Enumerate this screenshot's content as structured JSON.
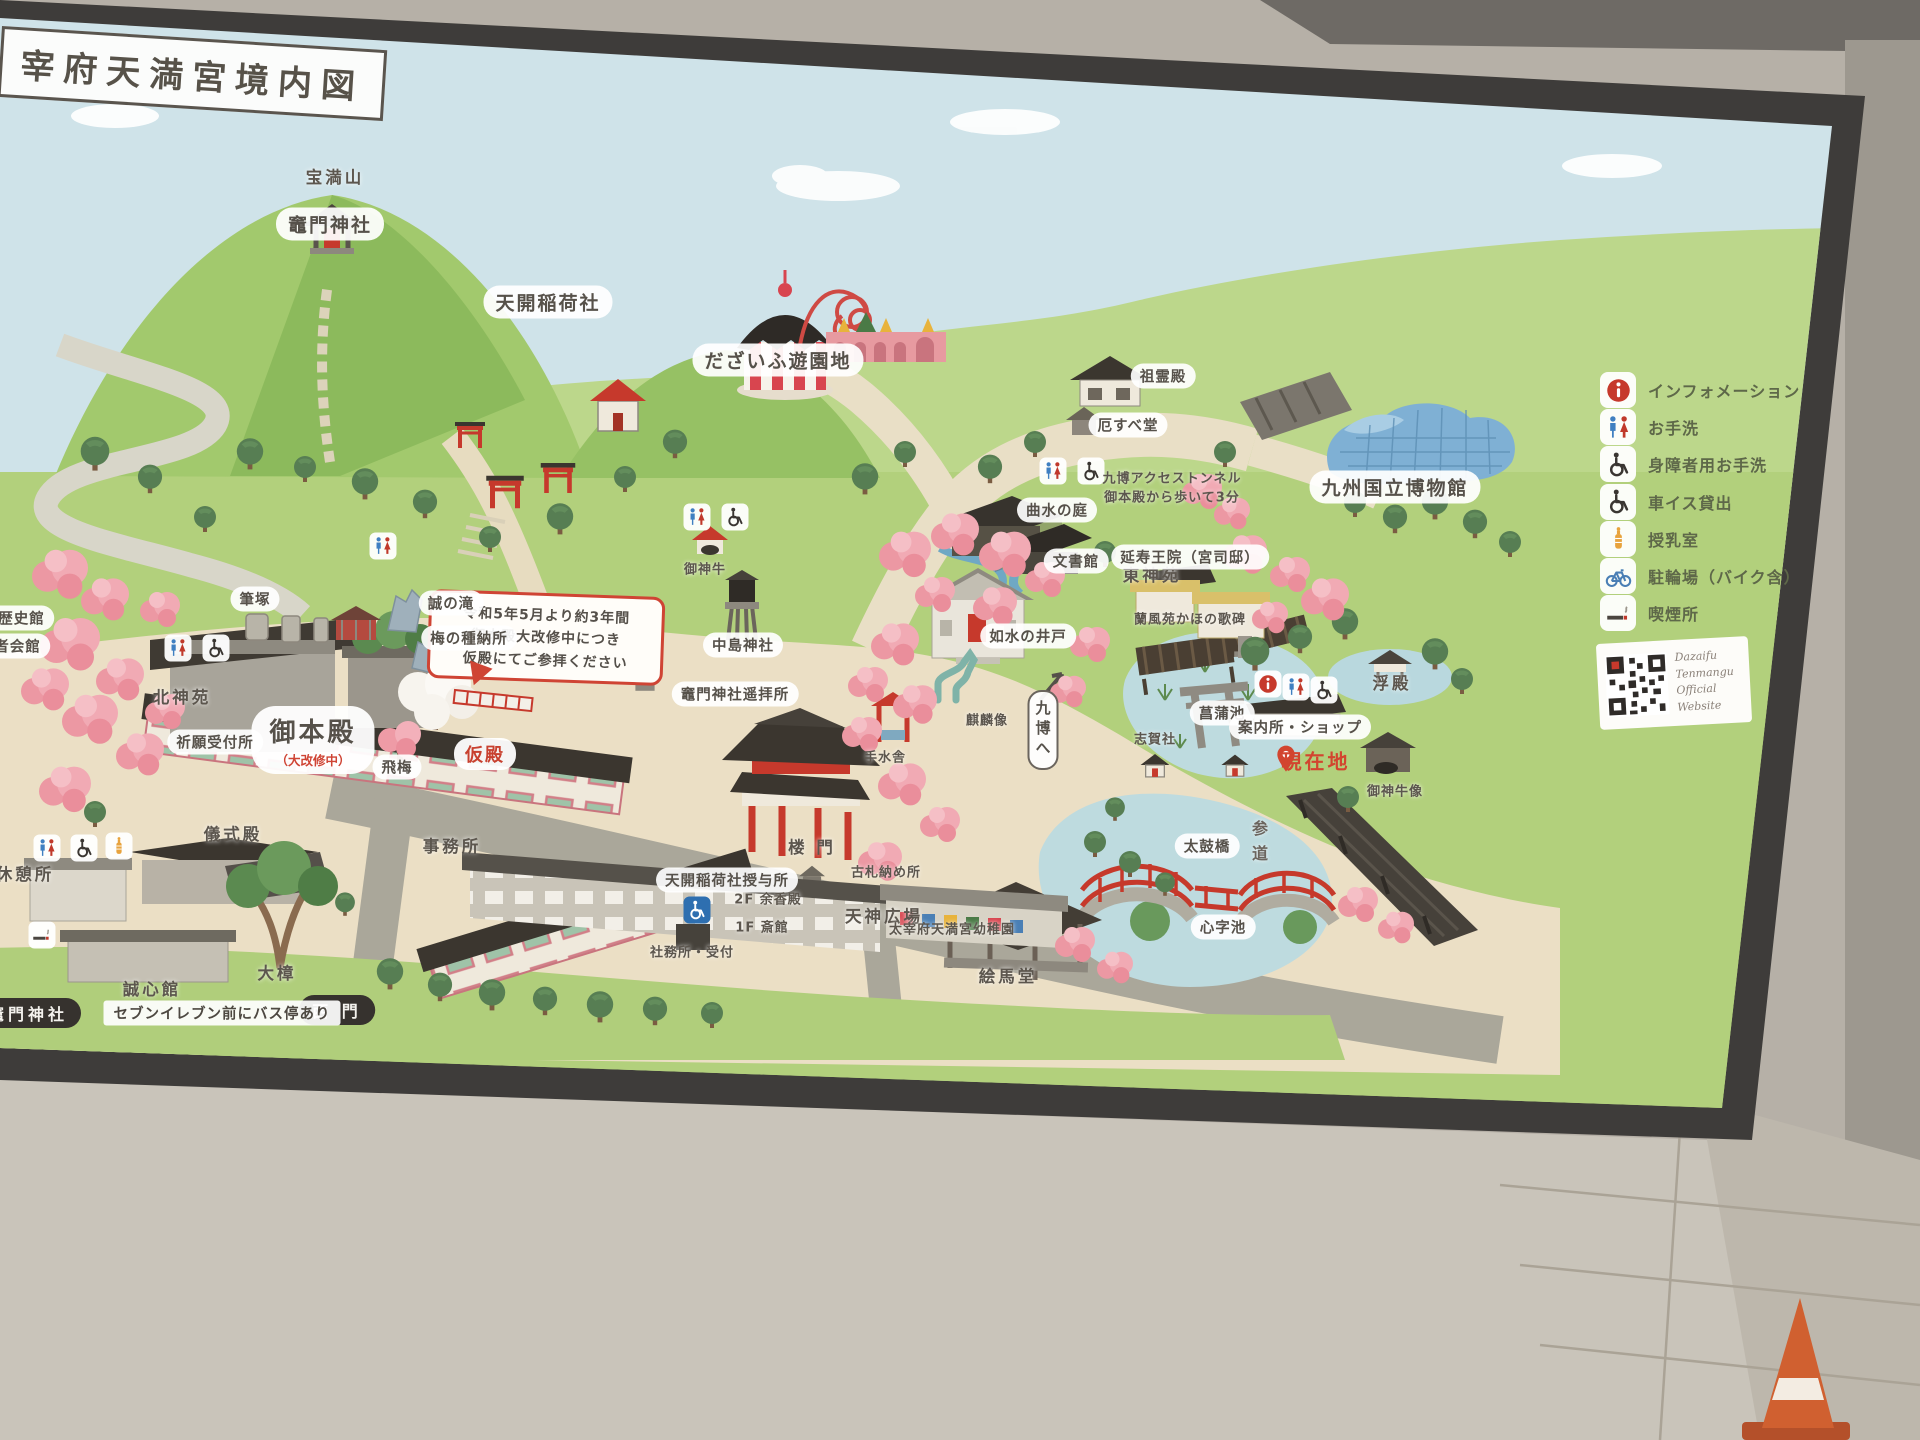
{
  "board": {
    "title": "宰府天満宮境内図",
    "notice_bubble": {
      "lines": [
        "令和5年5月より約3年間",
        "御本殿大改修中につき",
        "仮殿にてご参拝ください"
      ]
    },
    "legend": {
      "items": [
        {
          "icon": "info-icon",
          "label": "インフォメーション"
        },
        {
          "icon": "toilet-icon",
          "label": "お手洗"
        },
        {
          "icon": "wheelchair-icon",
          "label": "身障者用お手洗"
        },
        {
          "icon": "wheelchair-icon",
          "label": "車イス貸出"
        },
        {
          "icon": "nursing-icon",
          "label": "授乳室"
        },
        {
          "icon": "bicycle-icon",
          "label": "駐輪場（バイク含）"
        },
        {
          "icon": "smoking-icon",
          "label": "喫煙所"
        }
      ],
      "qr_caption_line1": "Dazaifu Tenmangu",
      "qr_caption_line2": "Official Website"
    },
    "labels": [
      {
        "n": "homanzan",
        "t": "宝満山",
        "x": 335,
        "y": 176,
        "s": "plain"
      },
      {
        "n": "kamado-jinja",
        "t": "竈門神社",
        "x": 330,
        "y": 224,
        "s": "pill"
      },
      {
        "n": "tenkai-inari-sha",
        "t": "天開稲荷社",
        "x": 548,
        "y": 302,
        "s": "pill"
      },
      {
        "n": "dazaifu-yuenchi",
        "t": "だざいふ遊園地",
        "x": 778,
        "y": 360,
        "s": "pill"
      },
      {
        "n": "soreiden",
        "t": "祖霊殿",
        "x": 1163,
        "y": 376,
        "s": "pill-sm"
      },
      {
        "n": "yakusube-do",
        "t": "厄すべ堂",
        "x": 1128,
        "y": 425,
        "s": "pill-sm"
      },
      {
        "n": "kyuhaku-access-tunnel",
        "t": "九博アクセストンネル",
        "x": 1172,
        "y": 477,
        "s": "plain-sm"
      },
      {
        "n": "tunnel-note",
        "t": "御本殿から歩いて3分",
        "x": 1172,
        "y": 496,
        "s": "plain-sm"
      },
      {
        "n": "kyushu-national-museum",
        "t": "九州国立博物館",
        "x": 1395,
        "y": 487,
        "s": "pill"
      },
      {
        "n": "kyokusui-no-niwa",
        "t": "曲水の庭",
        "x": 1057,
        "y": 510,
        "s": "pill-sm"
      },
      {
        "n": "bunshokan",
        "t": "文書館",
        "x": 1076,
        "y": 561,
        "s": "pill-sm"
      },
      {
        "n": "higashi-shin-en",
        "t": "東神苑",
        "x": 1152,
        "y": 574,
        "s": "plain"
      },
      {
        "n": "josui-no-ido",
        "t": "如水の井戸",
        "x": 1028,
        "y": 636,
        "s": "pill-sm"
      },
      {
        "n": "kirin-zo",
        "t": "麒麟像",
        "x": 987,
        "y": 719,
        "s": "plain-sm"
      },
      {
        "n": "kyuhaku-e",
        "t": "九博へ",
        "x": 1043,
        "y": 730,
        "s": "vpill"
      },
      {
        "n": "shobu-ike",
        "t": "菖蒲池",
        "x": 1222,
        "y": 713,
        "s": "pill-sm"
      },
      {
        "n": "shiga-sha",
        "t": "志賀社",
        "x": 1155,
        "y": 738,
        "s": "plain-sm"
      },
      {
        "n": "taiko-bashi",
        "t": "太鼓橋",
        "x": 1207,
        "y": 846,
        "s": "pill-sm"
      },
      {
        "n": "shinji-ike",
        "t": "心字池",
        "x": 1223,
        "y": 927,
        "s": "pill-sm"
      },
      {
        "n": "emado",
        "t": "絵馬堂",
        "x": 1008,
        "y": 975,
        "s": "plain"
      },
      {
        "n": "fudezuka",
        "t": "筆塚",
        "x": 255,
        "y": 599,
        "s": "pill-sm"
      },
      {
        "n": "makoto-no-taki",
        "t": "誠の滝",
        "x": 451,
        "y": 603,
        "s": "pill-sm"
      },
      {
        "n": "ume-no-tane-osamedokoro",
        "t": "梅の種納所",
        "x": 469,
        "y": 638,
        "s": "pill-sm"
      },
      {
        "n": "kita-shin-en",
        "t": "北神苑",
        "x": 182,
        "y": 696,
        "s": "plain"
      },
      {
        "n": "gohonden",
        "t": "御本殿",
        "x": 313,
        "y": 740,
        "s": "pill-lg",
        "sub": "（大改修中）"
      },
      {
        "n": "tobiume",
        "t": "飛梅",
        "x": 397,
        "y": 767,
        "s": "pill-sm"
      },
      {
        "n": "kariden",
        "t": "仮殿",
        "x": 485,
        "y": 754,
        "s": "pill-red"
      },
      {
        "n": "kamado-jinja-yohaijo",
        "t": "竈門神社遥拝所",
        "x": 735,
        "y": 694,
        "s": "pill-sm"
      },
      {
        "n": "goshingyu",
        "t": "御神牛",
        "x": 705,
        "y": 568,
        "s": "plain-sm"
      },
      {
        "n": "nakashima-jinja",
        "t": "中島神社",
        "x": 743,
        "y": 645,
        "s": "pill-sm"
      },
      {
        "n": "temizusha",
        "t": "手水舎",
        "x": 885,
        "y": 756,
        "s": "plain-sm"
      },
      {
        "n": "romon",
        "t": "楼 門",
        "x": 812,
        "y": 846,
        "s": "plain"
      },
      {
        "n": "kosatsu-osamedokoro",
        "t": "古札納め所",
        "x": 886,
        "y": 871,
        "s": "plain-sm"
      },
      {
        "n": "tenjin-hiroba",
        "t": "天神広場",
        "x": 884,
        "y": 915,
        "s": "plain"
      },
      {
        "n": "tenkai-inari-juyosho",
        "t": "天開稲荷社授与所",
        "x": 727,
        "y": 880,
        "s": "pill-sm"
      },
      {
        "n": "enjuoin",
        "t": "延寿王院（宮司邸）",
        "x": 1190,
        "y": 557,
        "s": "pill-sm"
      },
      {
        "n": "kahi",
        "t": "蘭風苑かほの歌碑",
        "x": 1190,
        "y": 618,
        "s": "plain-sm"
      },
      {
        "n": "ukidono",
        "t": "浮殿",
        "x": 1392,
        "y": 682,
        "s": "plain"
      },
      {
        "n": "annaijo-shop",
        "t": "案内所・ショップ",
        "x": 1300,
        "y": 727,
        "s": "pill-sm"
      },
      {
        "n": "genzaichi",
        "t": "現在地",
        "x": 1316,
        "y": 760,
        "s": "red"
      },
      {
        "n": "sando",
        "t": "参道",
        "x": 1258,
        "y": 845,
        "s": "vplain"
      },
      {
        "n": "goshingyu-zo",
        "t": "御神牛像",
        "x": 1395,
        "y": 790,
        "s": "plain-sm"
      },
      {
        "n": "yochien",
        "t": "太宰府天満宮幼稚園",
        "x": 952,
        "y": 928,
        "s": "plain-sm"
      },
      {
        "n": "yokoden-2f",
        "t": "2F 余香殿",
        "x": 768,
        "y": 898,
        "s": "plain-sm"
      },
      {
        "n": "saikan-1f",
        "t": "1F 斎館",
        "x": 762,
        "y": 926,
        "s": "plain-sm"
      },
      {
        "n": "shamusho-uketsuke",
        "t": "社務所・受付",
        "x": 692,
        "y": 951,
        "s": "plain-sm"
      },
      {
        "n": "jimusho",
        "t": "事務所",
        "x": 452,
        "y": 845,
        "s": "plain"
      },
      {
        "n": "gishikiden",
        "t": "儀式殿",
        "x": 233,
        "y": 833,
        "s": "plain"
      },
      {
        "n": "kyukeijo",
        "t": "休憩所",
        "x": 25,
        "y": 873,
        "s": "plain"
      },
      {
        "n": "seishinkan",
        "t": "誠心館",
        "x": 152,
        "y": 988,
        "s": "plain"
      },
      {
        "n": "okusu",
        "t": "大樟",
        "x": 277,
        "y": 972,
        "s": "plain"
      },
      {
        "n": "nishimon",
        "t": "西 門",
        "x": 337,
        "y": 1010,
        "s": "banner"
      },
      {
        "n": "kamado-jinja-bus-badge",
        "t": "竈門神社",
        "x": 28,
        "y": 1013,
        "s": "banner"
      },
      {
        "n": "bus-note",
        "t": "セブンイレブン前にバス停あり",
        "x": 222,
        "y": 1013,
        "s": "strip"
      },
      {
        "n": "kanko-rekishikan",
        "t": "菅公歴史館",
        "x": 6,
        "y": 618,
        "s": "pill-sm"
      },
      {
        "n": "sukeisha-kaikan",
        "t": "崇敬者会館",
        "x": 2,
        "y": 646,
        "s": "pill-sm"
      },
      {
        "n": "kigan-uketsukejo",
        "t": "祈願受付所",
        "x": 215,
        "y": 742,
        "s": "pill-sm"
      }
    ],
    "map_icons": [
      {
        "icon": "toilet-icon",
        "x": 383,
        "y": 546
      },
      {
        "icon": "toilet-icon",
        "x": 178,
        "y": 648
      },
      {
        "icon": "wheelchair-icon",
        "x": 216,
        "y": 648
      },
      {
        "icon": "toilet-icon",
        "x": 697,
        "y": 517
      },
      {
        "icon": "wheelchair-icon",
        "x": 735,
        "y": 517
      },
      {
        "icon": "toilet-icon",
        "x": 1053,
        "y": 471
      },
      {
        "icon": "wheelchair-icon",
        "x": 1091,
        "y": 471
      },
      {
        "icon": "toilet-icon",
        "x": 47,
        "y": 848
      },
      {
        "icon": "wheelchair-icon",
        "x": 84,
        "y": 848
      },
      {
        "icon": "nursing-icon",
        "x": 119,
        "y": 846
      },
      {
        "icon": "smoking-icon",
        "x": 42,
        "y": 935
      },
      {
        "icon": "info-icon",
        "x": 1268,
        "y": 684
      },
      {
        "icon": "toilet-icon",
        "x": 1296,
        "y": 687
      },
      {
        "icon": "wheelchair-icon",
        "x": 1324,
        "y": 690
      },
      {
        "icon": "accessible-sign-icon",
        "x": 697,
        "y": 910
      },
      {
        "icon": "pin-icon",
        "x": 1286,
        "y": 757
      }
    ]
  }
}
